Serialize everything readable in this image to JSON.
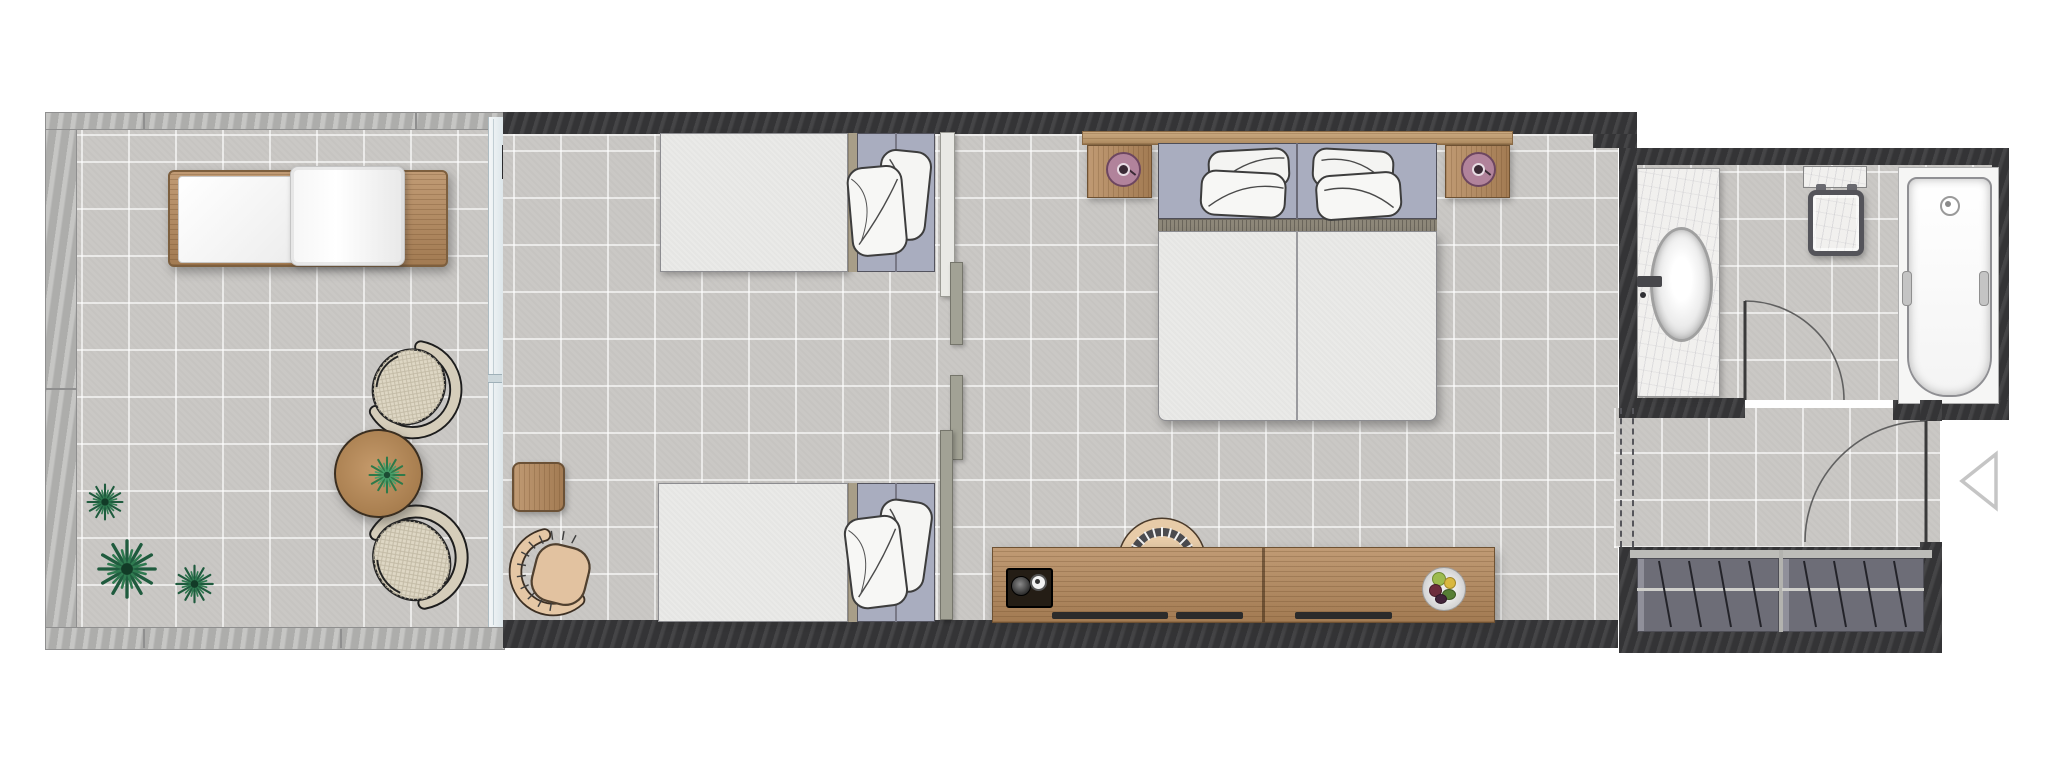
{
  "document": {
    "type": "floor-plan",
    "title": "Hotel guest room floor plan",
    "view": "top-down",
    "visible_text": []
  },
  "palette": {
    "background": "#ffffff",
    "wall_dark": "#3a3a3c",
    "wall_light": "#b6b6b4",
    "floor_tile": "#cac8c5",
    "wood": "#b5895c",
    "wood_light": "#c29b6b",
    "headboard_panel": "#a9adbf",
    "mattress": "#eaeae8",
    "pillow": "#f5f5f3",
    "glass": "#e9f0f3",
    "wicker": "#d5cdba",
    "tan_chair": "#e5c7a5",
    "lamp_mauve": "#b1839b",
    "plant_green": "#2f7a50",
    "marble": "#f1f0ee",
    "wardrobe_gray": "#6d6d77",
    "tub_white": "#ffffff"
  },
  "rooms": [
    {
      "id": "terrace",
      "name": "Terrace",
      "furniture": [
        "sun-lounger",
        "wicker-chair",
        "wicker-chair",
        "round-coffee-table",
        "table-plant",
        "potted-plant",
        "potted-plant",
        "potted-plant"
      ]
    },
    {
      "id": "twin-bedroom",
      "name": "Twin bedroom",
      "furniture": [
        "single-bed",
        "single-bed",
        "side-table",
        "lounge-chair",
        "sliding-partition-panels",
        "glass-wall"
      ]
    },
    {
      "id": "king-bedroom",
      "name": "King bedroom",
      "furniture": [
        "double-bed",
        "headboard-shelf",
        "nightstand",
        "nightstand",
        "table-lamp",
        "table-lamp",
        "console-desk",
        "desk-chair",
        "coffee-tray",
        "fruit-plate"
      ]
    },
    {
      "id": "bathroom",
      "name": "Bathroom",
      "furniture": [
        "vanity-counter",
        "oval-sink",
        "faucet",
        "toilet",
        "bathtub",
        "swing-door"
      ]
    },
    {
      "id": "entry",
      "name": "Entry corridor",
      "furniture": [
        "entry-door",
        "entry-marker",
        "wardrobe",
        "hanging-rails"
      ]
    }
  ]
}
